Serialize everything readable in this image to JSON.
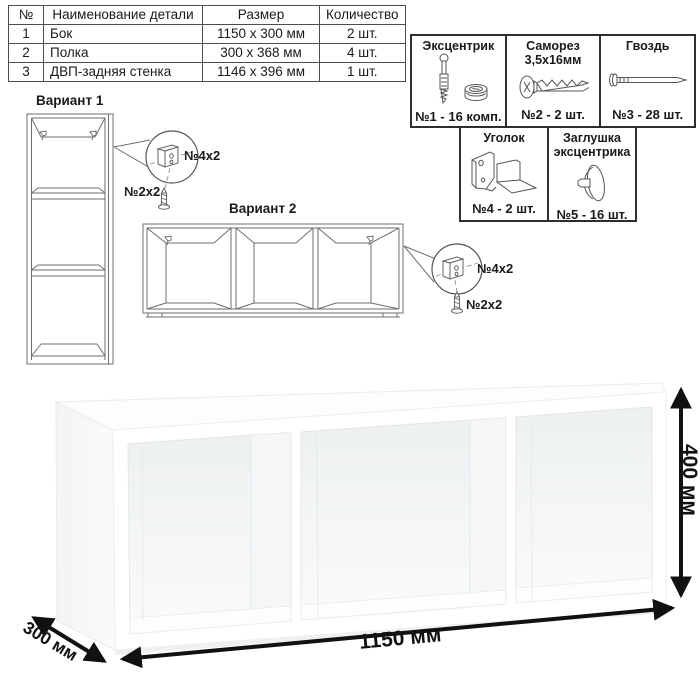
{
  "parts_table": {
    "headers": [
      "№",
      "Наименование детали",
      "Размер",
      "Количество"
    ],
    "rows": [
      [
        "1",
        "Бок",
        "1150 x 300 мм",
        "2 шт."
      ],
      [
        "2",
        "Полка",
        "300 x 368 мм",
        "4 шт."
      ],
      [
        "3",
        "ДВП-задняя стенка",
        "1146 x 396 мм",
        "1 шт."
      ]
    ]
  },
  "hardware": {
    "items": [
      {
        "title": "Эксцентрик",
        "count": "№1 - 16 комп."
      },
      {
        "title": "Саморез 3,5х16мм",
        "count": "№2 - 2 шт."
      },
      {
        "title": "Гвоздь",
        "count": "№3 - 28 шт."
      },
      {
        "title": "Уголок",
        "count": "№4 - 2 шт."
      },
      {
        "title": "Заглушка эксцентрика",
        "count": "№5 - 16 шт."
      }
    ]
  },
  "variants": {
    "v1": {
      "title": "Вариант 1",
      "bracket_label": "№4х2",
      "screw_label": "№2х2"
    },
    "v2": {
      "title": "Вариант 2",
      "bracket_label": "№4х2",
      "screw_label": "№2х2"
    }
  },
  "dimensions": {
    "width": "1150 мм",
    "depth": "300 мм",
    "height": "400 мм"
  },
  "colors": {
    "ink": "#1a1a1a",
    "line": "#6e6e6e",
    "dim_arrow": "#111111"
  }
}
